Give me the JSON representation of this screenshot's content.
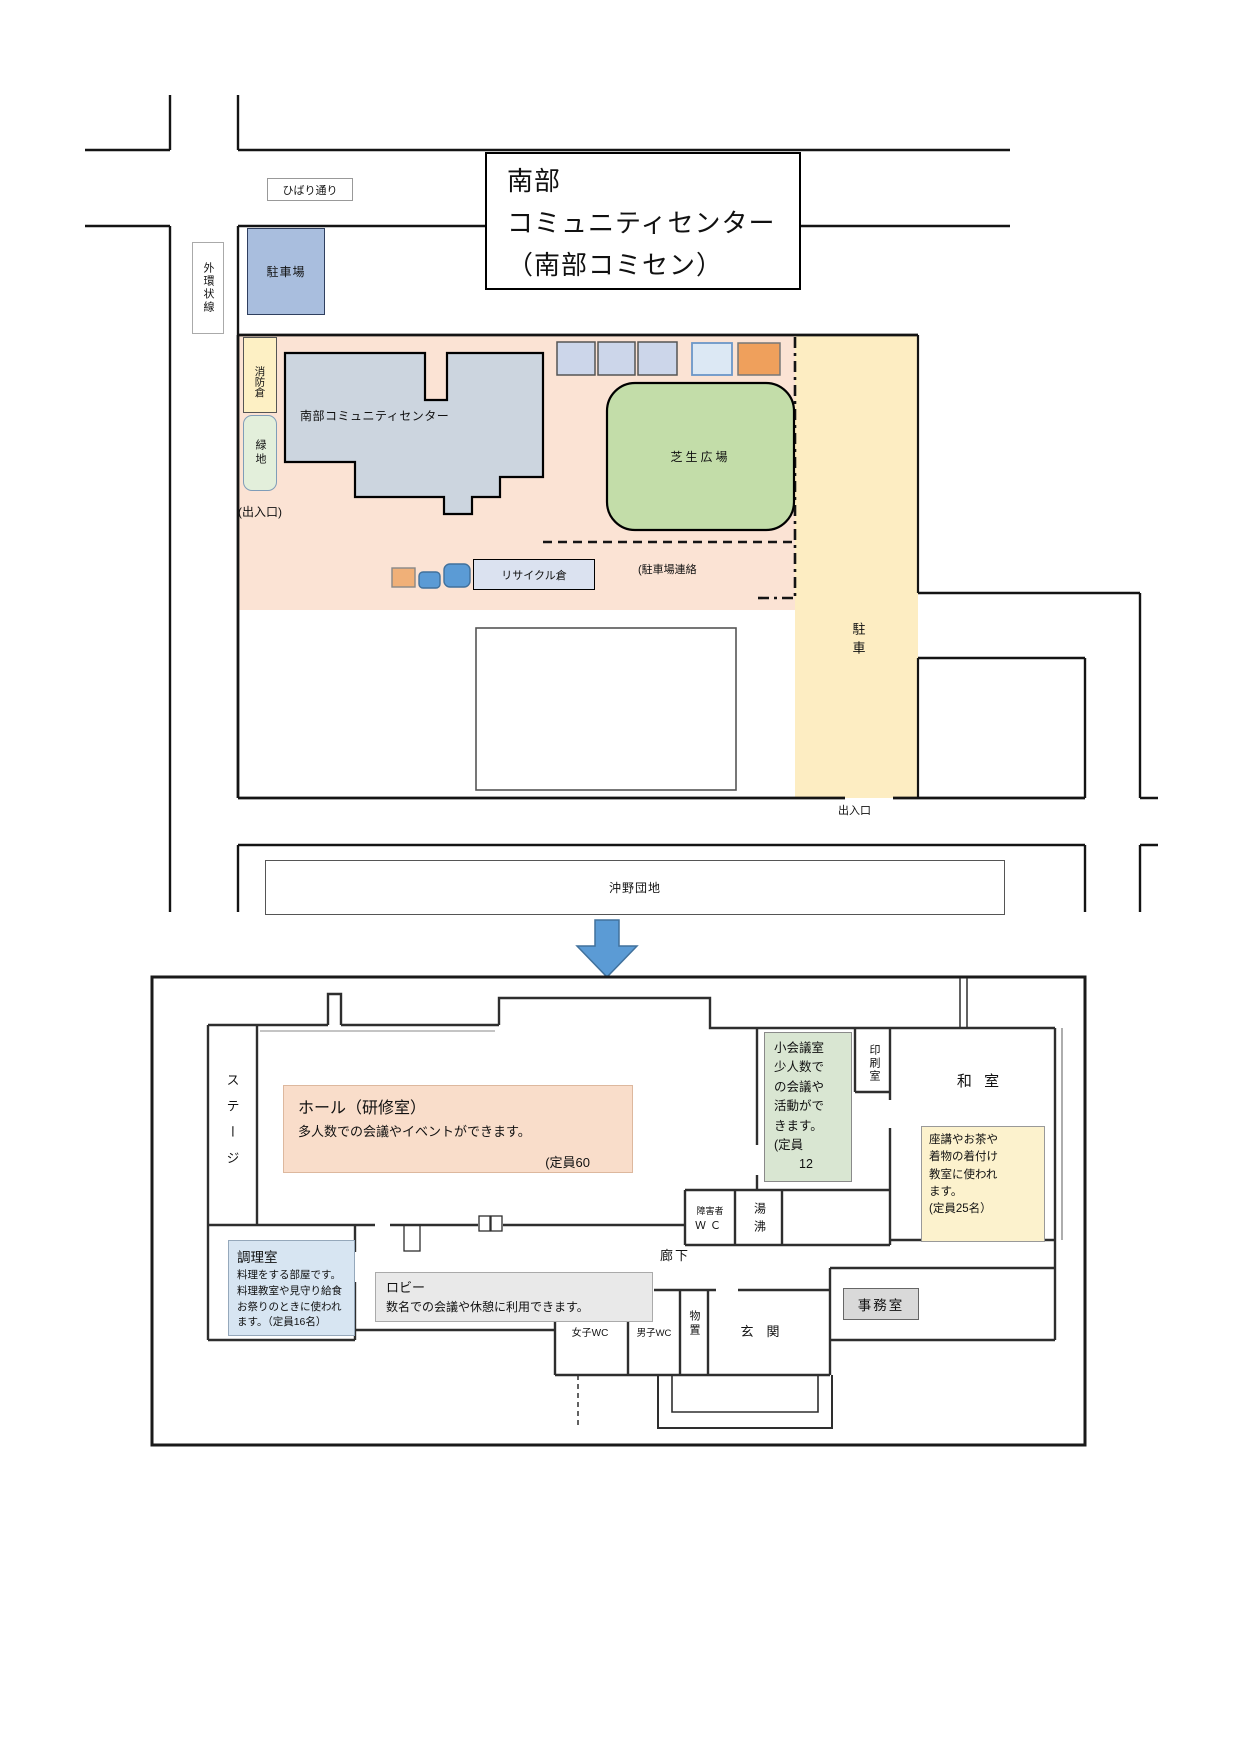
{
  "site": {
    "title": [
      "南部",
      "コミュニティセンター",
      "（南部コミセン）"
    ],
    "roads": {
      "hibari": "ひばり通り",
      "ring": "外環状線",
      "okino": "沖野団地"
    },
    "labels": {
      "parking_north": "駐車場",
      "fire_store": "消防倉",
      "green": "緑地",
      "entrance_west": "(出入口)",
      "building": "南部コミュニティセンター",
      "lawn": "芝生広場",
      "recycle": "リサイクル倉",
      "parking_link": "(駐車場連絡",
      "parking_east": "駐車",
      "entrance_south": "出入口"
    }
  },
  "floor": {
    "stage": "ステージ",
    "hall": {
      "title": "ホール（研修室）",
      "desc": "多人数での会議やイベントができます。",
      "capacity": "(定員60"
    },
    "small_meeting": "小会議室\n少人数で\nの会議や\n活動がで\nきます。\n(定員\n　　12",
    "print_room": "印刷室",
    "washitsu": {
      "name": "和 室",
      "desc": "座講やお茶や\n着物の着付け\n教室に使われ\nます。\n(定員25名）"
    },
    "accessible_wc": [
      "障害者",
      "ＷＣ"
    ],
    "hot_water": "湯沸",
    "kitchen": {
      "title": "調理室",
      "desc": "料理をする部屋です。\n料理教室や見守り給食\nお祭りのときに使われ\nます。（定員16名）"
    },
    "lobby": {
      "title": "ロビー",
      "desc": "数名での会議や休憩に利用できます。"
    },
    "corridor": "廊下",
    "wc_women": "女子WC",
    "wc_men": "男子WC",
    "storage": "物置",
    "entrance": "玄　関",
    "office": "事務室"
  },
  "colors": {
    "site_ground": "#fbe3d4",
    "parking_yellow": "#fdedc2",
    "lawn_green": "#c3dda9",
    "building_gray": "#ccd5df",
    "parking_blue_box": "#a9bede",
    "arrow_blue": "#5b9bd5",
    "hall_note": "#f9ddca",
    "meeting_note": "#d9e6d2",
    "washitsu_note": "#fcf2cd",
    "kitchen_note": "#d7e5f2",
    "lobby_note": "#e9e9e9"
  }
}
